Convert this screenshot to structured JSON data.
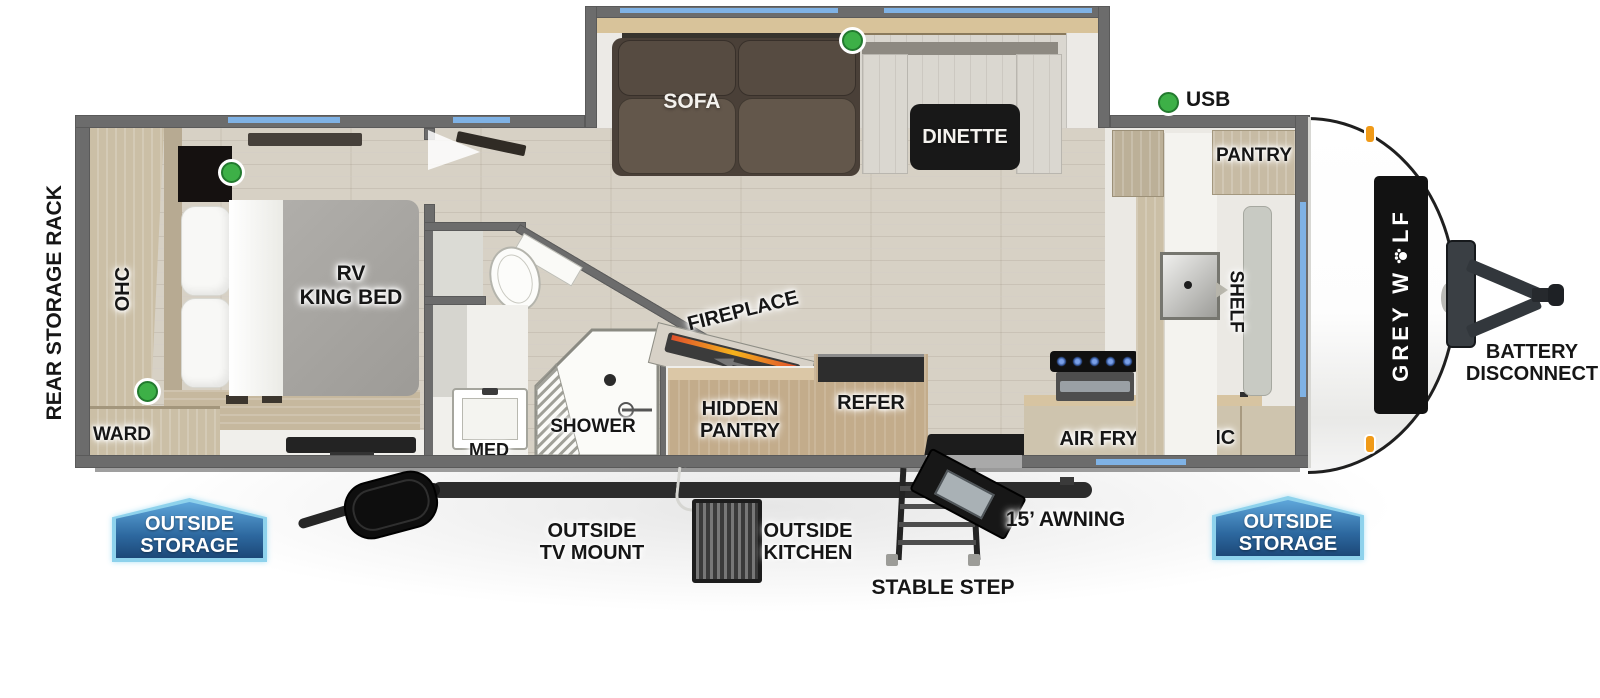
{
  "title": "Grey Wolf travel trailer floor plan",
  "colors": {
    "window_blue": "#7fb2e5",
    "usb_green": "#3db047",
    "badge_blue": "#2d689f",
    "badge_border": "#8ed2ec",
    "wall_gray": "#6c6c6c",
    "marker_orange": "#f09a18"
  },
  "legend": {
    "usb": "USB"
  },
  "bedroom": {
    "ohc": "OHC",
    "ward": "WARD",
    "bed": [
      "RV",
      "KING BED"
    ]
  },
  "bath": {
    "med": "MED",
    "shower": "SHOWER"
  },
  "living": {
    "sofa": "SOFA",
    "dinette": "DINETTE",
    "fireplace": "FIREPLACE",
    "hidden_pantry": [
      "HIDDEN",
      "PANTRY"
    ],
    "refer": "REFER"
  },
  "kitchen": {
    "air_fryer": "AIR FRYER",
    "ohc": "OHC",
    "shelf": "SHELF",
    "pantry": "PANTRY"
  },
  "exterior": {
    "rear_rack": "REAR STORAGE RACK",
    "brand": {
      "full": "GREY WOLF",
      "left": "GREY W",
      "right": "LF"
    },
    "battery": [
      "BATTERY",
      "DISCONNECT"
    ],
    "awning": "15’ AWNING",
    "stable_step": "STABLE STEP",
    "outside_tv": [
      "OUTSIDE",
      "TV MOUNT"
    ],
    "outside_kitchen": [
      "OUTSIDE",
      "KITCHEN"
    ],
    "storage_left": [
      "OUTSIDE",
      "STORAGE"
    ],
    "storage_right": [
      "OUTSIDE",
      "STORAGE"
    ]
  }
}
